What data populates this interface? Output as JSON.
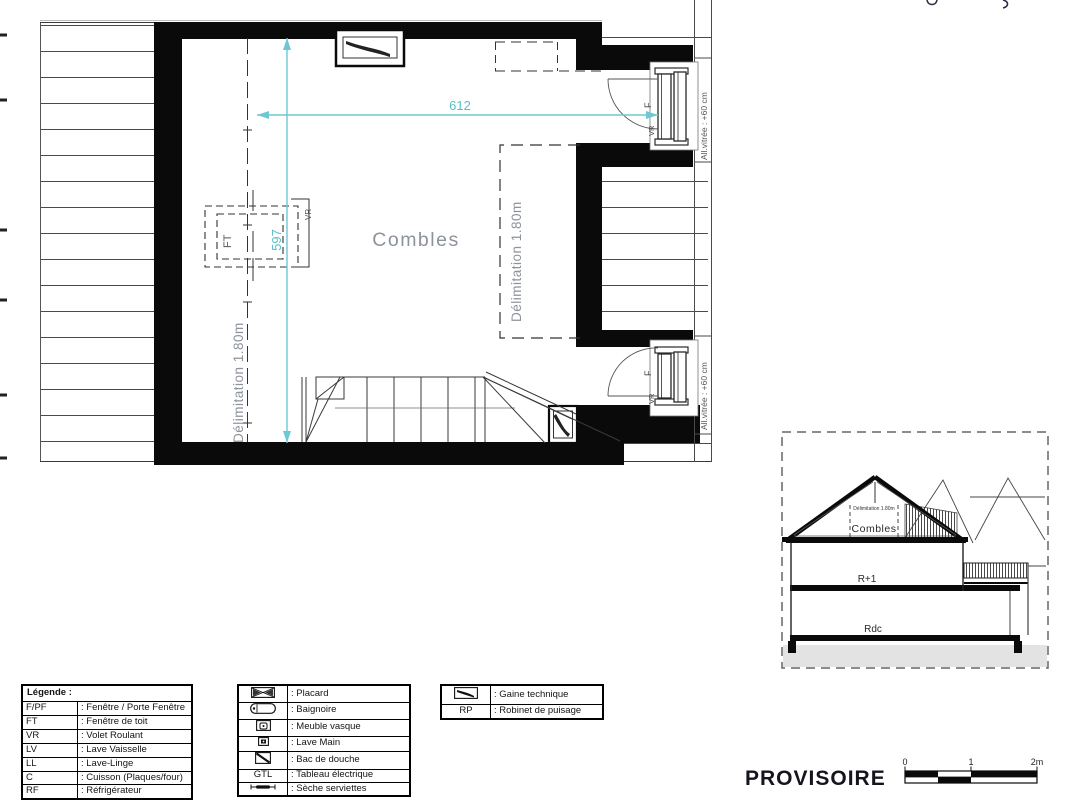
{
  "palette": {
    "accent_cyan": "#6ec8d2",
    "wall_black": "#0a0a0a",
    "muted_gray": "#8d939b"
  },
  "plan": {
    "room_label": "Combles",
    "dim_width": "612",
    "dim_height": "597",
    "delimitation_left": "Délimitation 1.80m",
    "delimitation_right": "Délimitation 1.80m",
    "roof_window": {
      "type_label": "FT",
      "shutter_label": "VR"
    },
    "window_top": {
      "type_label": "F",
      "shutter_label": "VR",
      "sill_note": "All.vitrée : +60 cm"
    },
    "window_bottom": {
      "type_label": "F",
      "shutter_label": "VR",
      "sill_note": "All.vitrée : +60 cm"
    }
  },
  "section": {
    "delimitation": "Délimitation 1.80m",
    "attic_label": "Combles",
    "first_floor_label": "R+1",
    "ground_floor_label": "Rdc"
  },
  "legend_abbreviations": {
    "title": "Légende :",
    "rows": [
      {
        "abbr": "F/PF",
        "desc": ": Fenêtre / Porte Fenêtre"
      },
      {
        "abbr": "FT",
        "desc": ": Fenêtre de toit"
      },
      {
        "abbr": "VR",
        "desc": ": Volet Roulant"
      },
      {
        "abbr": "LV",
        "desc": ": Lave Vaisselle"
      },
      {
        "abbr": "LL",
        "desc": ": Lave-Linge"
      },
      {
        "abbr": "C",
        "desc": ": Cuisson (Plaques/four)"
      },
      {
        "abbr": "RF",
        "desc": ": Réfrigérateur"
      }
    ]
  },
  "legend_symbols": {
    "rows": [
      {
        "icon": "placard-icon",
        "desc": ": Placard"
      },
      {
        "icon": "bathtub-icon",
        "desc": ": Baignoire"
      },
      {
        "icon": "washbasin-cabinet-icon",
        "desc": ": Meuble vasque"
      },
      {
        "icon": "hand-basin-icon",
        "desc": ": Lave Main"
      },
      {
        "icon": "shower-tray-icon",
        "desc": ": Bac de douche"
      },
      {
        "abbr": "GTL",
        "desc": ": Tableau électrique"
      },
      {
        "icon": "towel-dryer-icon",
        "desc": ": Sèche serviettes"
      }
    ]
  },
  "legend_technical": {
    "rows": [
      {
        "icon": "technical-duct-icon",
        "desc": ": Gaine technique"
      },
      {
        "abbr": "RP",
        "desc": ": Robinet de puisage"
      }
    ]
  },
  "footer": {
    "status_label": "PROVISOIRE"
  },
  "scale_bar": {
    "tick_0": "0",
    "tick_1": "1",
    "tick_2": "2m"
  }
}
